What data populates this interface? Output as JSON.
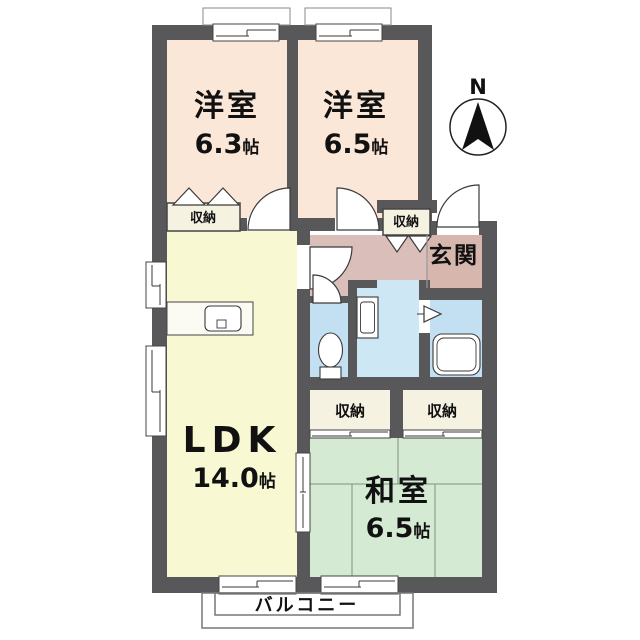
{
  "compass": {
    "label": "N"
  },
  "rooms": {
    "bedroom1": {
      "name": "洋室",
      "size_num": "6.3",
      "size_unit": "帖"
    },
    "bedroom2": {
      "name": "洋室",
      "size_num": "6.5",
      "size_unit": "帖"
    },
    "ldk": {
      "name": "LDK",
      "size_num": "14.0",
      "size_unit": "帖"
    },
    "japanese_room": {
      "name": "和室",
      "size_num": "6.5",
      "size_unit": "帖"
    },
    "entrance": {
      "name": "玄関"
    },
    "balcony": {
      "name": "バルコニー"
    }
  },
  "closets": {
    "bedroom1_closet": {
      "label": "収納"
    },
    "hall_closet": {
      "label": "収納"
    },
    "japanese_room_closet_left": {
      "label": "収納"
    },
    "japanese_room_closet_right": {
      "label": "収納"
    }
  },
  "colors": {
    "wall": "#58585a",
    "bedroom": "#fbe7d8",
    "ldk": "#f8f8d2",
    "tatami": "#d5ead3",
    "hall": "#d9beb9",
    "entrance": "#d6b6ad",
    "wet": "#c3e0f2",
    "wet_light": "#cde7f5",
    "closet": "#f6f2e2",
    "counter": "#fbfbf3"
  }
}
